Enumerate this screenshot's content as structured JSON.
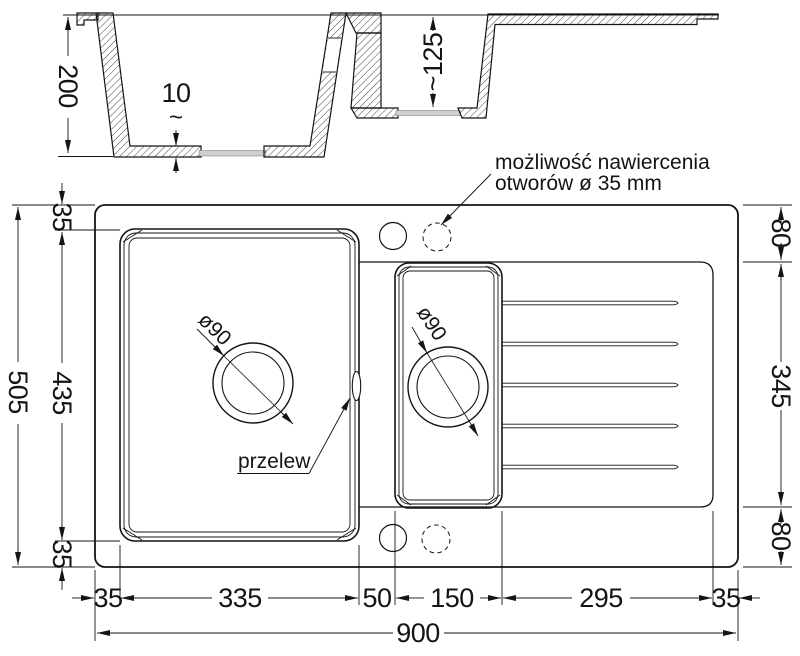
{
  "annotations": {
    "drill_note_line1": "możliwość nawiercenia",
    "drill_note_line2": "otworów ø 35 mm",
    "overflow": "przelew",
    "main_drain": "ø90",
    "small_drain": "ø90"
  },
  "dims": {
    "depth_main": "200",
    "floor_thick_num": "10",
    "floor_thick_tilde": "~",
    "depth_small": "~125",
    "left_margin_top": "35",
    "left_total": "505",
    "left_basin": "435",
    "left_margin_bottom": "35",
    "right_deck_top": "80",
    "right_drainer": "345",
    "right_deck_bottom": "80",
    "bottom_margin_left": "35",
    "bottom_main_basin": "335",
    "bottom_gap": "50",
    "bottom_small_basin": "150",
    "bottom_drainer": "295",
    "bottom_margin_right": "35",
    "bottom_total": "900"
  }
}
